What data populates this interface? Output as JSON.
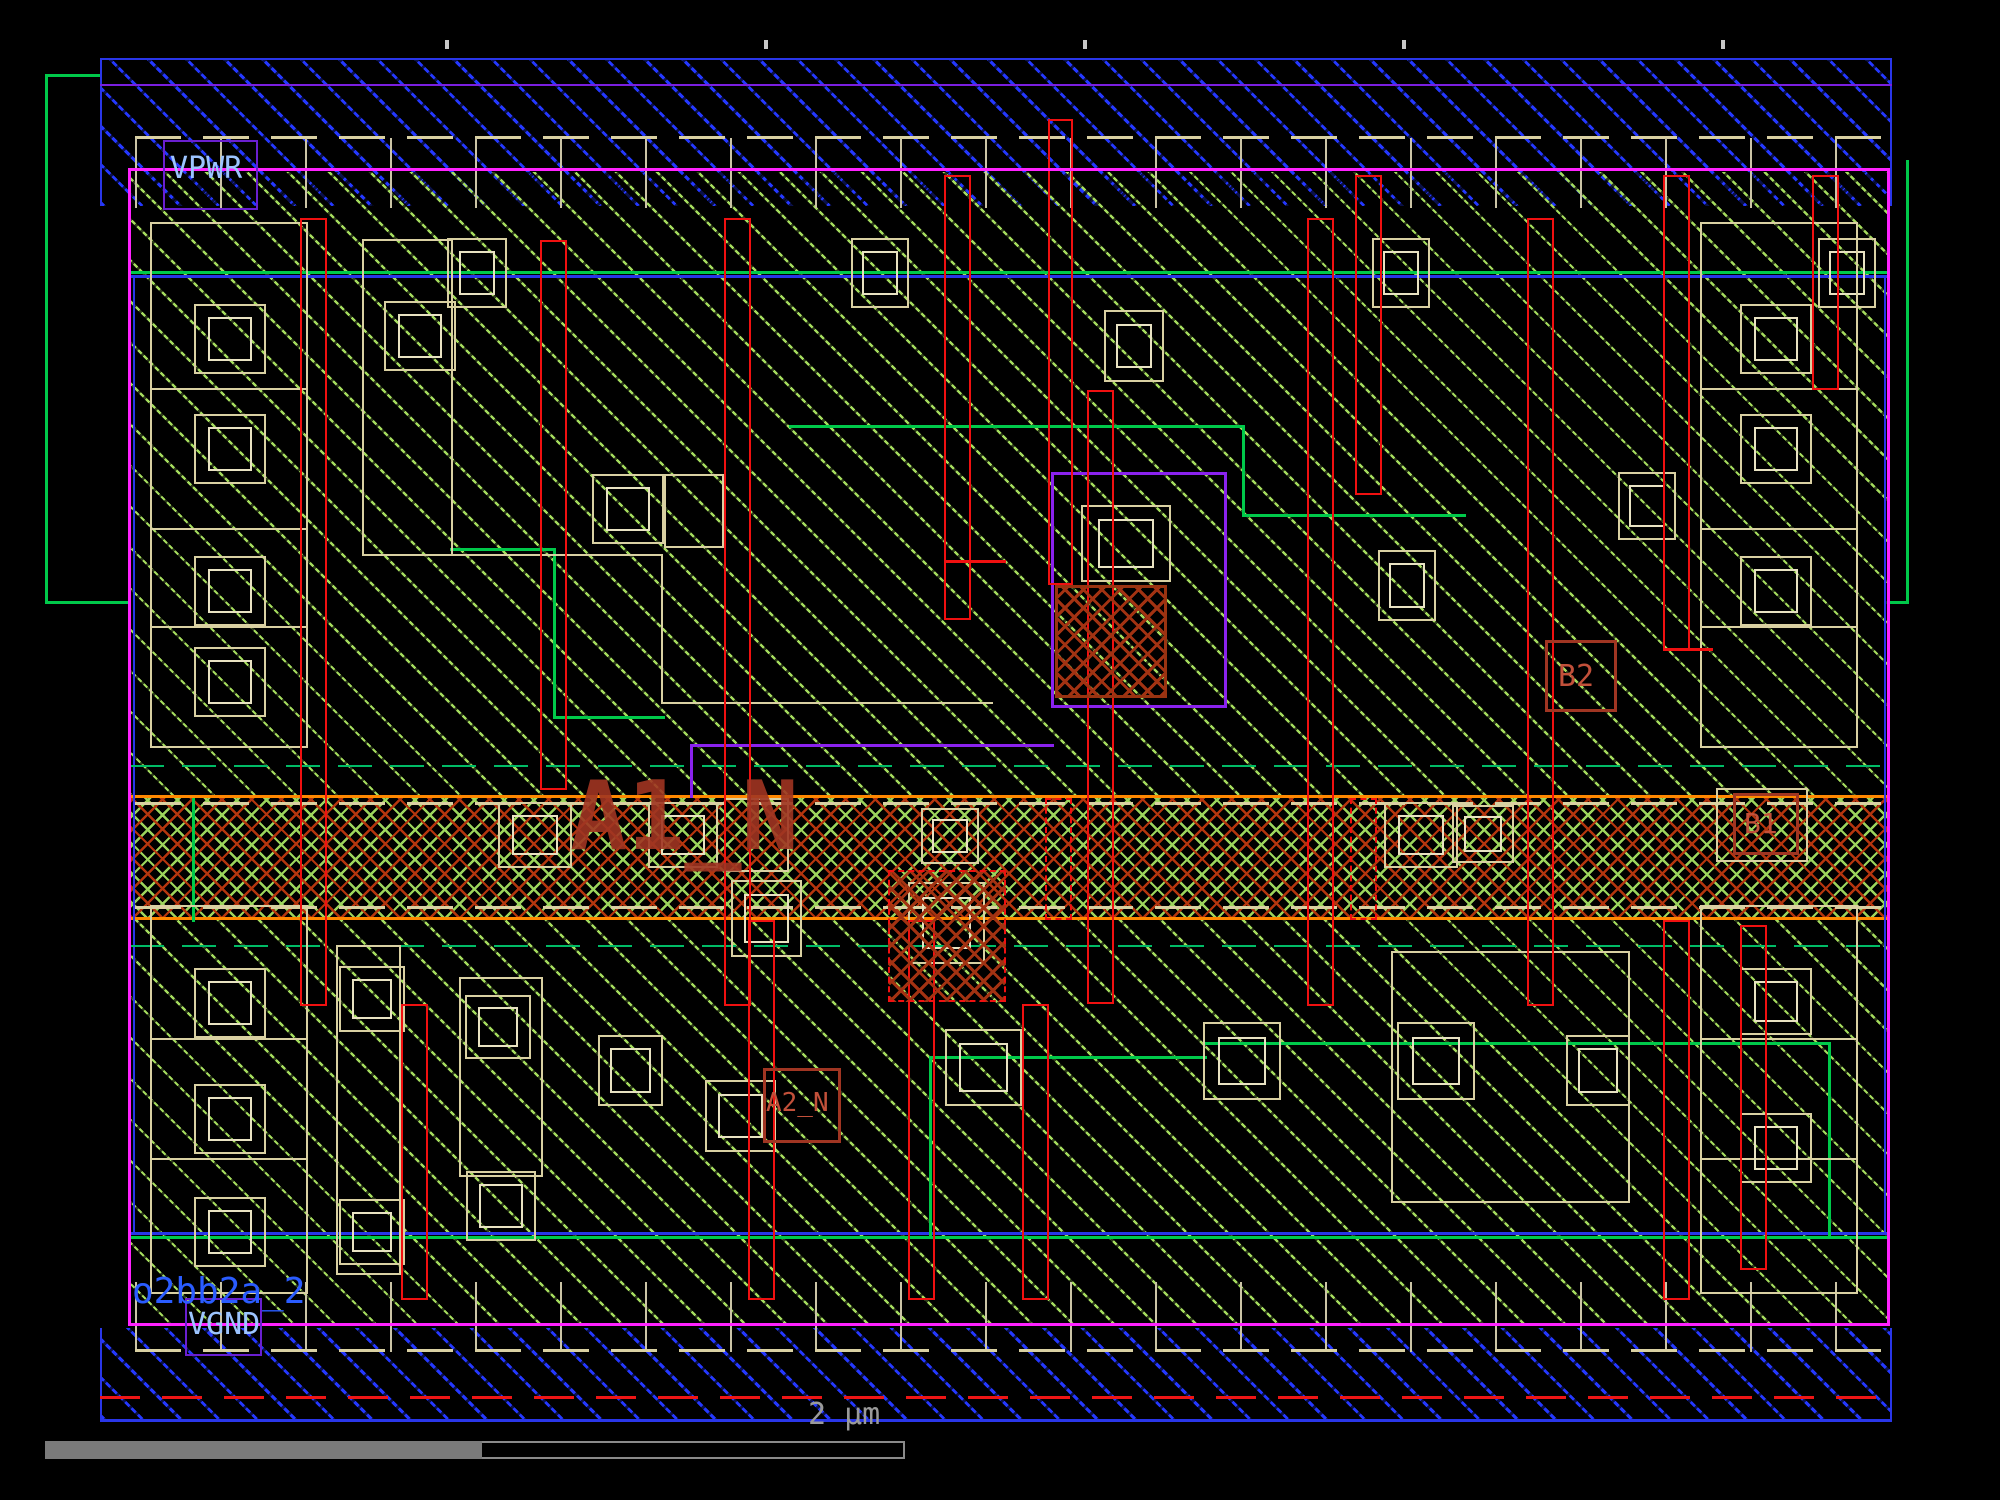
{
  "app": {
    "type": "ic-layout-viewer"
  },
  "labels": {
    "power_rail": "VPWR",
    "ground_rail": "VGND",
    "cell_name": "o2bb2a_2",
    "pin_a1_n": "A1_N",
    "pin_a2_n": "A2_N",
    "pin_b1": "B1",
    "pin_b2": "B2",
    "scale": "2 µm"
  },
  "colors": {
    "background": "#000000",
    "cell_boundary_magenta": "#ff22ff",
    "nwell_green": "#00c94a",
    "metal_rail_blue": "#2438ff",
    "metal_edge_blue": "#2936e8",
    "poly_red": "#f01010",
    "li_tan": "#d9d0a2",
    "tap_band_orange_edge": "#ff8800",
    "tap_hatch_red": "#b4350e",
    "diffusion_hatch_green": "#a5dc5e",
    "met1_purple": "#8a22ee",
    "net_label_sky_blue": "#9cc4ff",
    "cell_name_blue": "#2a5cff",
    "pin_label_maroon": "#c2503a",
    "scale_gray": "#9a9a9a"
  }
}
